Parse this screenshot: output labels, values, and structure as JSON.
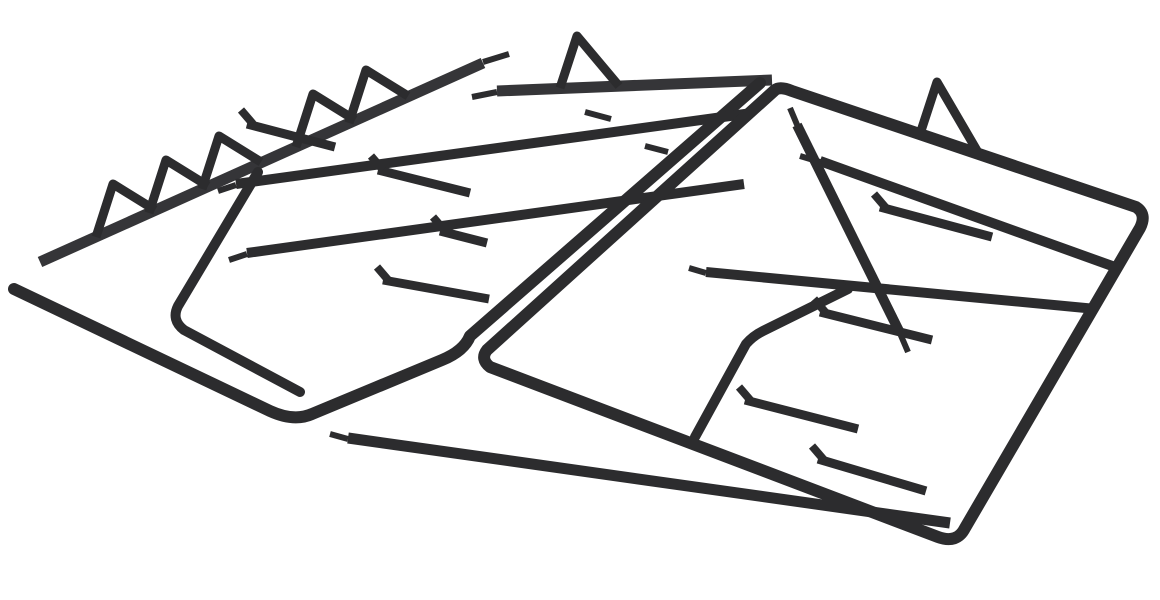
{
  "scene": {
    "description": "Pair of black cast iron gas hob pan support grates, shown upside down with triangular feet pointing up, on a white background",
    "canvas": {
      "width": 1160,
      "height": 600
    },
    "background": "#ffffff",
    "colors": {
      "iron": "#2c2c2e",
      "iron_light": "#353538"
    },
    "grates": [
      {
        "name": "left-grate",
        "bars": [
          {
            "name": "back-rail",
            "d": "M 40 262 L 483 63",
            "w": 11,
            "tone": "iron_light"
          },
          {
            "name": "back-rail-tip",
            "d": "M 483 62 L 509 54",
            "w": 6
          },
          {
            "name": "top-rail",
            "d": "M 497 91 L 772 80",
            "w": 11,
            "tone": "iron_light"
          },
          {
            "name": "top-rail-tip",
            "d": "M 472 97 L 497 92",
            "w": 6
          },
          {
            "name": "outline",
            "d": "M 14 289 L 270 411 Q 294 422 312 414 L 442 360 Q 464 351 470 336 L 760 83",
            "w": 12,
            "cap": "round"
          },
          {
            "name": "mid-rail-1",
            "d": "M 236 184 L 752 113",
            "w": 10
          },
          {
            "name": "mid-rail-1-tip",
            "d": "M 218 191 L 236 185",
            "w": 6
          },
          {
            "name": "mid-rail-2",
            "d": "M 247 253 L 744 184",
            "w": 10
          },
          {
            "name": "mid-rail-2-tip",
            "d": "M 229 260 L 247 254",
            "w": 6
          },
          {
            "name": "inner-corner-rail",
            "d": "M 258 172 L 178 306 Q 171 320 184 330 L 300 392",
            "w": 10,
            "cap": "round"
          },
          {
            "name": "finger-1",
            "d": "M 378 170 L 470 193",
            "w": 9
          },
          {
            "name": "finger-1-hook",
            "d": "M 383 170 L 371 156",
            "w": 8
          },
          {
            "name": "finger-2",
            "d": "M 440 231 L 487 243",
            "w": 9
          },
          {
            "name": "finger-2-hook",
            "d": "M 445 231 L 433 217",
            "w": 8
          },
          {
            "name": "finger-3",
            "d": "M 383 280 L 489 299",
            "w": 9
          },
          {
            "name": "finger-3-hook",
            "d": "M 389 281 L 377 267",
            "w": 8
          },
          {
            "name": "finger-4",
            "d": "M 247 124 L 335 147",
            "w": 9
          },
          {
            "name": "finger-4-hook",
            "d": "M 253 124 L 241 110",
            "w": 8
          },
          {
            "name": "stray-rail-tip-1",
            "d": "M 585 112 L 611 119",
            "w": 6
          },
          {
            "name": "stray-rail-tip-2",
            "d": "M 645 146 L 668 152",
            "w": 6
          }
        ],
        "feet": [
          {
            "name": "foot-1",
            "d": "M 96 237 L 113 184 L 155 210"
          },
          {
            "name": "foot-2",
            "d": "M 149 213 L 166 160 L 208 186"
          },
          {
            "name": "foot-3",
            "d": "M 202 189 L 219 136 L 261 162"
          },
          {
            "name": "foot-4",
            "d": "M 296 147 L 313 94 L 355 120"
          },
          {
            "name": "foot-5",
            "d": "M 349 123 L 366 70 L 408 96"
          },
          {
            "name": "foot-6",
            "d": "M 560 88 L 577 36 L 619 86"
          }
        ]
      },
      {
        "name": "right-grate",
        "bars": [
          {
            "name": "frame",
            "d": "M 775 90 L 487 350 Q 480 359 490 367 L 938 537 Q 957 544 965 528 L 1140 228 Q 1147 214 1136 207 L 792 91 Q 780 86 775 90 Z",
            "w": 12
          },
          {
            "name": "cross-rail-1",
            "d": "M 820 161 L 1115 267",
            "w": 10
          },
          {
            "name": "cross-rail-1-tip",
            "d": "M 800 156 L 820 162",
            "w": 6
          },
          {
            "name": "cross-rail-2",
            "d": "M 706 272 L 1096 309",
            "w": 10
          },
          {
            "name": "cross-rail-2-tip",
            "d": "M 689 268 L 706 273",
            "w": 6
          },
          {
            "name": "cross-rail-3",
            "d": "M 348 438 L 950 523",
            "w": 11
          },
          {
            "name": "cross-rail-3-tip",
            "d": "M 330 434 L 348 439",
            "w": 6
          },
          {
            "name": "depth-rail-1",
            "d": "M 797 125 L 900 333",
            "w": 10
          },
          {
            "name": "depth-rail-1-tip-a",
            "d": "M 790 108 L 798 127",
            "w": 6
          },
          {
            "name": "depth-rail-1-tip-b",
            "d": "M 899 331 L 908 352",
            "w": 6
          },
          {
            "name": "depth-rail-2",
            "d": "M 695 437 L 746 344 Q 753 336 763 331 L 848 289",
            "w": 10,
            "cap": "round"
          },
          {
            "name": "finger-1",
            "d": "M 880 207 L 992 237",
            "w": 9
          },
          {
            "name": "finger-1-hook",
            "d": "M 886 208 L 874 194",
            "w": 8
          },
          {
            "name": "finger-2",
            "d": "M 820 312 L 932 340",
            "w": 9
          },
          {
            "name": "finger-2-hook",
            "d": "M 826 313 L 814 299",
            "w": 8
          },
          {
            "name": "finger-3",
            "d": "M 745 400 L 858 429",
            "w": 9
          },
          {
            "name": "finger-3-hook",
            "d": "M 751 401 L 739 387",
            "w": 8
          },
          {
            "name": "finger-4",
            "d": "M 818 459 L 926 491",
            "w": 9
          },
          {
            "name": "finger-4-hook",
            "d": "M 824 460 L 812 446",
            "w": 8
          }
        ],
        "feet": [
          {
            "name": "foot-7",
            "d": "M 920 134 L 937 82 L 979 154"
          }
        ]
      }
    ]
  }
}
